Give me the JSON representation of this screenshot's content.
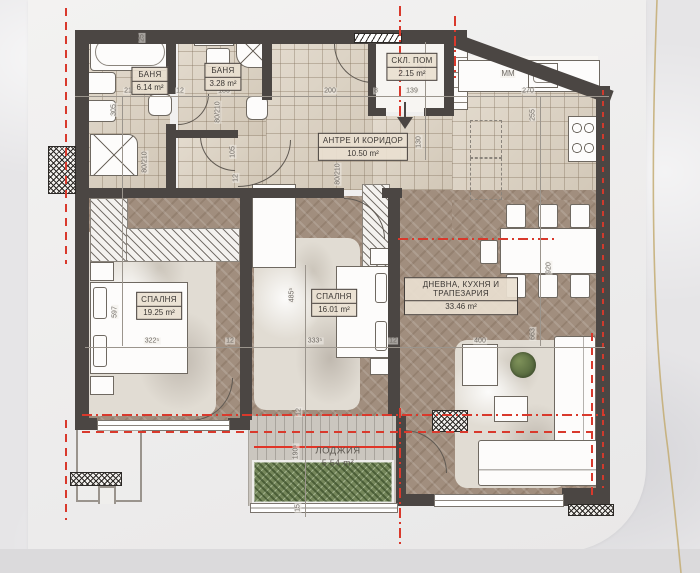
{
  "plan": {
    "rooms": [
      {
        "name": "БАНЯ",
        "area": "6.14 m²"
      },
      {
        "name": "БАНЯ",
        "area": "3.28 m²"
      },
      {
        "name": "СКЛ. ПОМ",
        "area": "2.15 m²"
      },
      {
        "name": "АНТРЕ И КОРИДОР",
        "area": "10.50 m²"
      },
      {
        "name": "СПАЛНЯ",
        "area": "19.25 m²"
      },
      {
        "name": "СПАЛНЯ",
        "area": "16.01 m²"
      },
      {
        "name": "ДНЕВНА, КУХНЯ И ТРАПЕЗАРИЯ",
        "area": "33.46 m²"
      },
      {
        "name": "ЛОДЖИЯ",
        "area": "5.54 m²"
      }
    ],
    "appliance_label": "ММ",
    "dims": [
      {
        "t": "25"
      },
      {
        "t": "215"
      },
      {
        "t": "12"
      },
      {
        "t": "185"
      },
      {
        "t": "200"
      },
      {
        "t": "8"
      },
      {
        "t": "139"
      },
      {
        "t": "270"
      },
      {
        "t": "305"
      },
      {
        "t": "153"
      },
      {
        "t": "255"
      },
      {
        "t": "130"
      },
      {
        "t": "105"
      },
      {
        "t": "80/210"
      },
      {
        "t": "80/210"
      },
      {
        "t": "80/210"
      },
      {
        "t": "597"
      },
      {
        "t": "485⁵"
      },
      {
        "t": "920"
      },
      {
        "t": "663"
      },
      {
        "t": "322⁵"
      },
      {
        "t": "12"
      },
      {
        "t": "333⁵"
      },
      {
        "t": "12"
      },
      {
        "t": "400"
      },
      {
        "t": "12"
      },
      {
        "t": "190⁵"
      },
      {
        "t": "15"
      },
      {
        "t": "12"
      }
    ],
    "colors": {
      "wall": "#4b4643",
      "section_red": "#d9392c",
      "gold_accent": "#c3ac72",
      "tile_floor": "#dacfbe",
      "wood_floor": "#a18e7e"
    }
  }
}
